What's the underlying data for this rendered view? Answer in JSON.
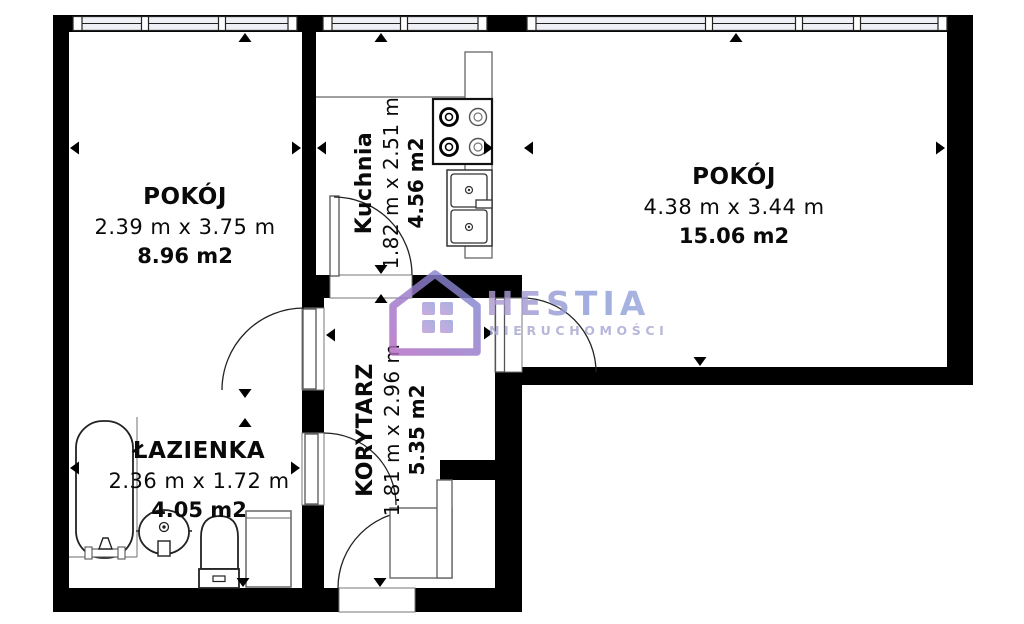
{
  "watermark": {
    "brand": "HESTIA",
    "subtitle": "NIERUCHOMOŚCI"
  },
  "rooms": {
    "room_left": {
      "name": "POKÓJ",
      "dims": "2.39 m x 3.75 m",
      "area": "8.96 m2"
    },
    "kitchen": {
      "name": "Kuchnia",
      "dims": "1.82 m x 2.51 m",
      "area": "4.56 m2"
    },
    "room_right": {
      "name": "POKÓJ",
      "dims": "4.38 m x 3.44 m",
      "area": "15.06 m2"
    },
    "bathroom": {
      "name": "ŁAZIENKA",
      "dims": "2.36 m x 1.72 m",
      "area": "4.05 m2"
    },
    "corridor": {
      "name": "KORYTARZ",
      "dims": "1.81 m x 2.96 m",
      "area": "5.35 m2"
    }
  },
  "colors": {
    "wall": "#000000",
    "window_fill": "#eef0f6",
    "logo_blue": "#7b8ad2",
    "logo_purple": "#b26cc4",
    "logo_text": "#8d9dd8"
  },
  "fixtures": [
    "bathtub",
    "washbasin",
    "toilet",
    "washing-machine",
    "stove",
    "kitchen-sink",
    "counter",
    "wardrobe"
  ]
}
